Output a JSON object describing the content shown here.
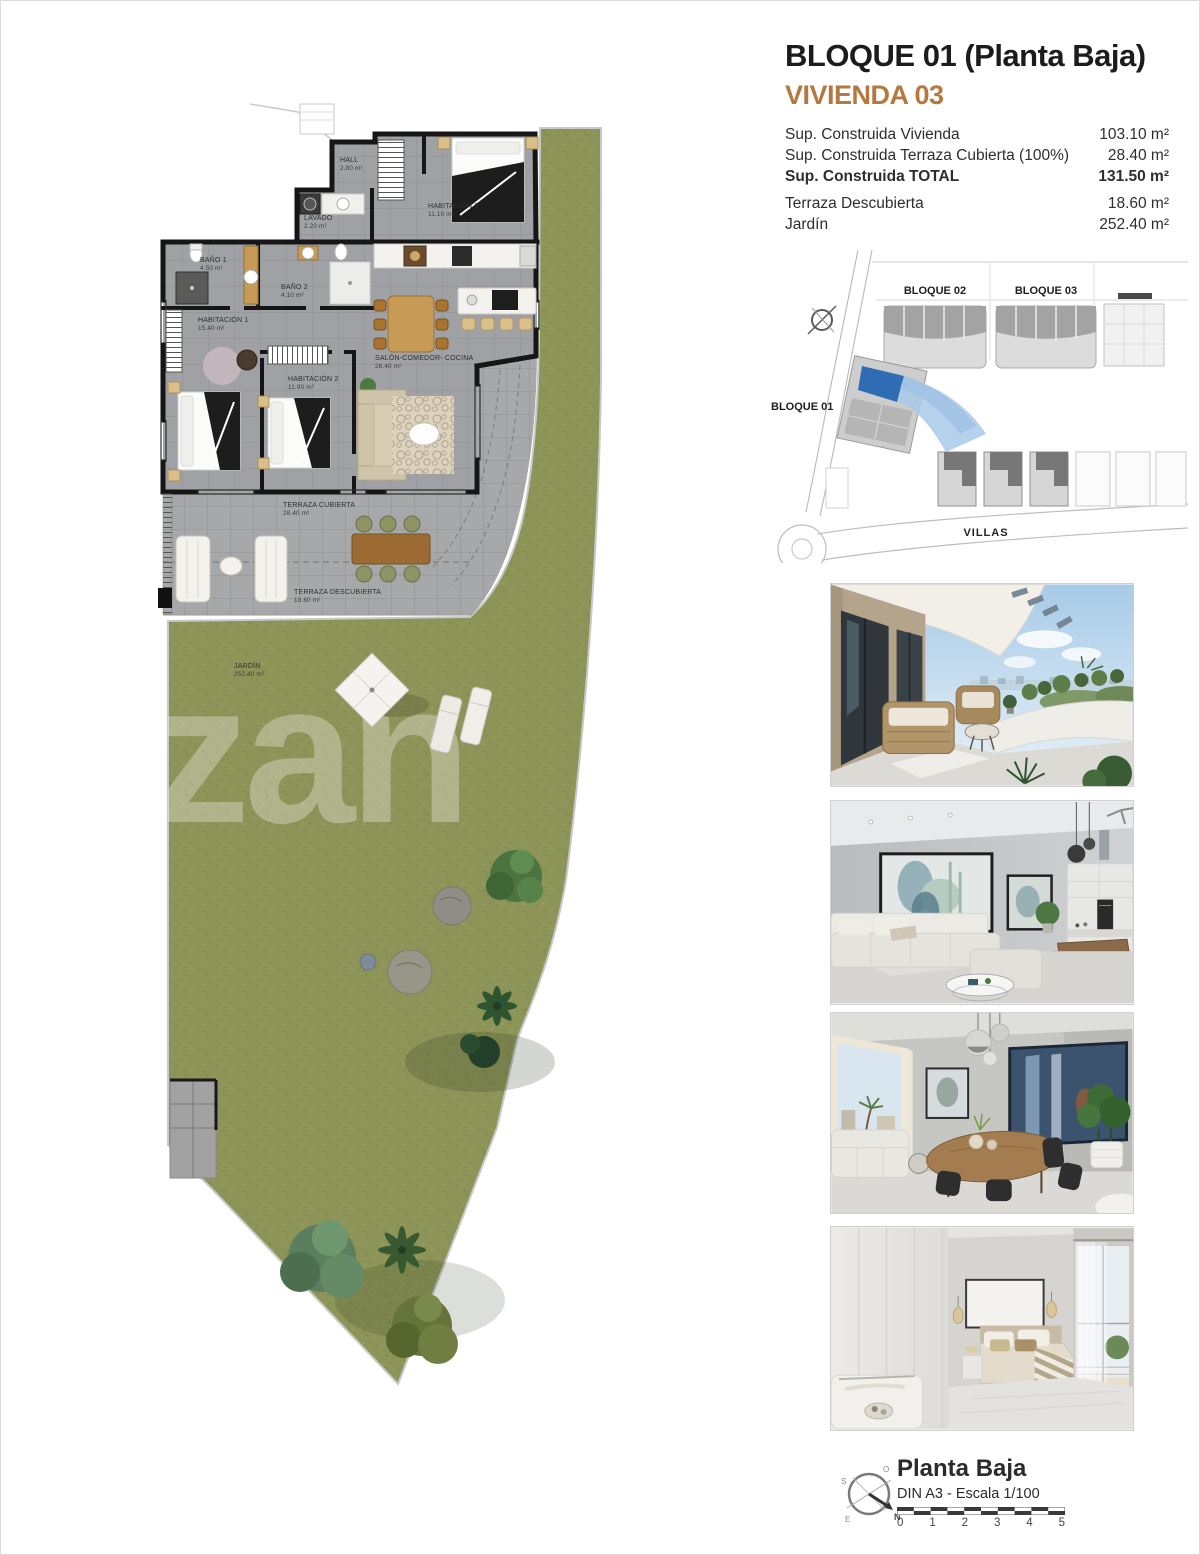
{
  "header": {
    "title": "BLOQUE 01  (Planta Baja)",
    "subtitle": "VIVIENDA 03",
    "accent_color": "#b3793f"
  },
  "surface_table": {
    "rows": [
      {
        "label": "Sup. Construida Vivienda",
        "value": "103.10 m²"
      },
      {
        "label": "Sup. Construida Terraza Cubierta (100%)",
        "value": "28.40 m²"
      },
      {
        "label": "Sup. Construida TOTAL",
        "value": "131.50 m²"
      },
      {
        "label": "Terraza Descubierta",
        "value": "18.60 m²"
      },
      {
        "label": "Jardín",
        "value": "252.40 m²"
      }
    ]
  },
  "site_plan": {
    "bloque01": "BLOQUE 01",
    "bloque02": "BLOQUE 02",
    "bloque03": "BLOQUE 03",
    "villas": "VILLAS",
    "highlight_color": "#2e6db4",
    "highlight_light": "#a9c9e8"
  },
  "floor_plan": {
    "watermark": "zan",
    "grass_color": "#8d9458",
    "floor_color": "#9fa1a4",
    "terrace_color": "#a6a8aa",
    "rooms": [
      {
        "name": "HALL",
        "area": "2.80 m²"
      },
      {
        "name": "LAVADO",
        "area": "2.20 m²"
      },
      {
        "name": "HABITACIÓN 3",
        "area": "11.10 m²"
      },
      {
        "name": "BAÑO 1",
        "area": "4.50 m²"
      },
      {
        "name": "BAÑO 2",
        "area": "4.10 m²"
      },
      {
        "name": "HABITACIÓN 1",
        "area": "15.40 m²"
      },
      {
        "name": "HABITACIÓN 2",
        "area": "11.90 m²"
      },
      {
        "name": "SALÓN-COMEDOR- COCINA",
        "area": "26.40 m²"
      },
      {
        "name": "TERRAZA CUBIERTA",
        "area": "28.40 m²"
      },
      {
        "name": "TERRAZA DESCUBIERTA",
        "area": "18.60 m²"
      },
      {
        "name": "JARDÍN",
        "area": "252.40 m²"
      }
    ]
  },
  "photos": [
    {
      "label": "terraza"
    },
    {
      "label": "salón"
    },
    {
      "label": "comedor"
    },
    {
      "label": "dormitorio"
    }
  ],
  "footer": {
    "plan_name": "Planta Baja",
    "scale_text": "DIN A3 - Escala 1/100",
    "ticks": [
      "0",
      "1",
      "2",
      "3",
      "4",
      "5"
    ],
    "compass": {
      "n": "N",
      "s": "S",
      "e": "E",
      "o": "O"
    }
  }
}
